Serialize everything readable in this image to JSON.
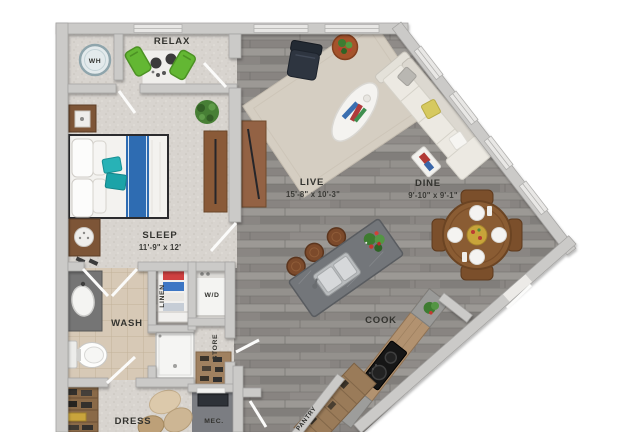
{
  "floorplan": {
    "type": "apartment-floor-plan",
    "labels": {
      "wh": "WH",
      "relax": "RELAX",
      "sleep": "SLEEP",
      "sleep_dims": "11'-9\" x 12'",
      "live": "LIVE",
      "live_dims": "15'-8\" x 10'-3\"",
      "dine": "DINE",
      "dine_dims": "9'-10\" x 9'-1\"",
      "wash": "WASH",
      "linen": "LINEN",
      "wd": "W/D",
      "store": "STORE",
      "cook": "COOK",
      "dress": "DRESS",
      "mec": "MEC.",
      "pantry": "PANTRY"
    },
    "colors": {
      "wall": "#cbcac8",
      "wood_floor": "#908d89",
      "carpet": "#d8d4cf",
      "bath_tile": "#d7c9b6",
      "bed_runner_blue": "#2e6cb2",
      "teal_pillow": "#28b2b6",
      "green_chair": "#63b733",
      "island_gray": "#73767a",
      "sofa_cream": "#ece9e2",
      "rug_beige": "#d5cec2",
      "dining_wood": "#8a5c33",
      "counter_wood": "#b29270",
      "yellow_pillow": "#d6c95f",
      "mec_floor": "#7b7d82"
    }
  }
}
